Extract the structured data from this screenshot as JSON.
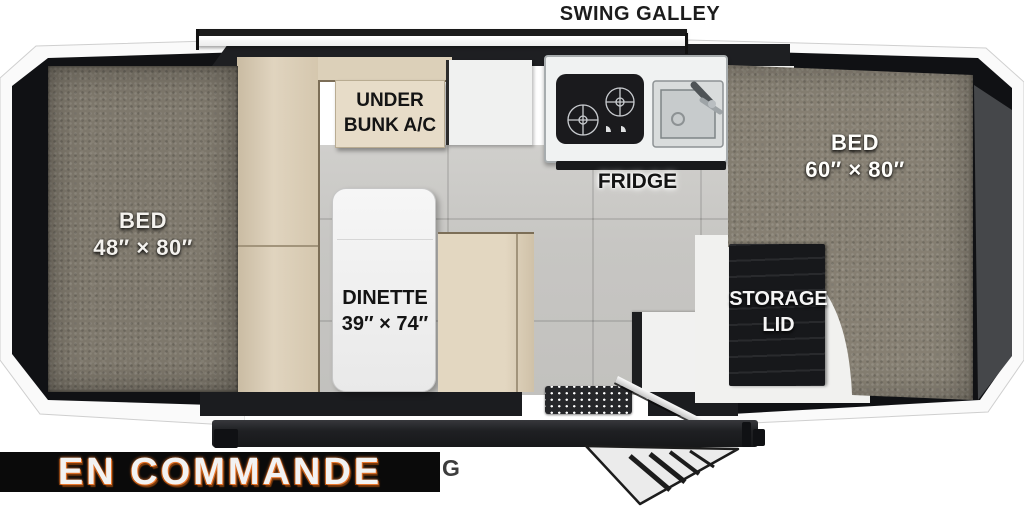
{
  "title": "SWING GALLEY",
  "areas": {
    "bed_left": {
      "name": "BED",
      "size": "48″ × 80″"
    },
    "bed_right": {
      "name": "BED",
      "size": "60″ × 80″"
    },
    "under_bunk": {
      "line1": "UNDER",
      "line2": "BUNK A/C"
    },
    "fridge": {
      "label": "FRIDGE"
    },
    "dinette": {
      "name": "DINETTE",
      "size": "39″ × 74″"
    },
    "storage": {
      "line1": "STORAGE",
      "line2": "LID"
    }
  },
  "banner": {
    "text": "EN COMMANDE"
  },
  "partial": {
    "awning_suffix": "G"
  },
  "colors": {
    "accent_orange": "#e8762c",
    "banner_bg": "#0a0a0a",
    "mattress": "#7e786c",
    "bench_tan": "#e0d4bf",
    "floor_gray": "#c7c6c3",
    "shell_dark": "#101114"
  }
}
